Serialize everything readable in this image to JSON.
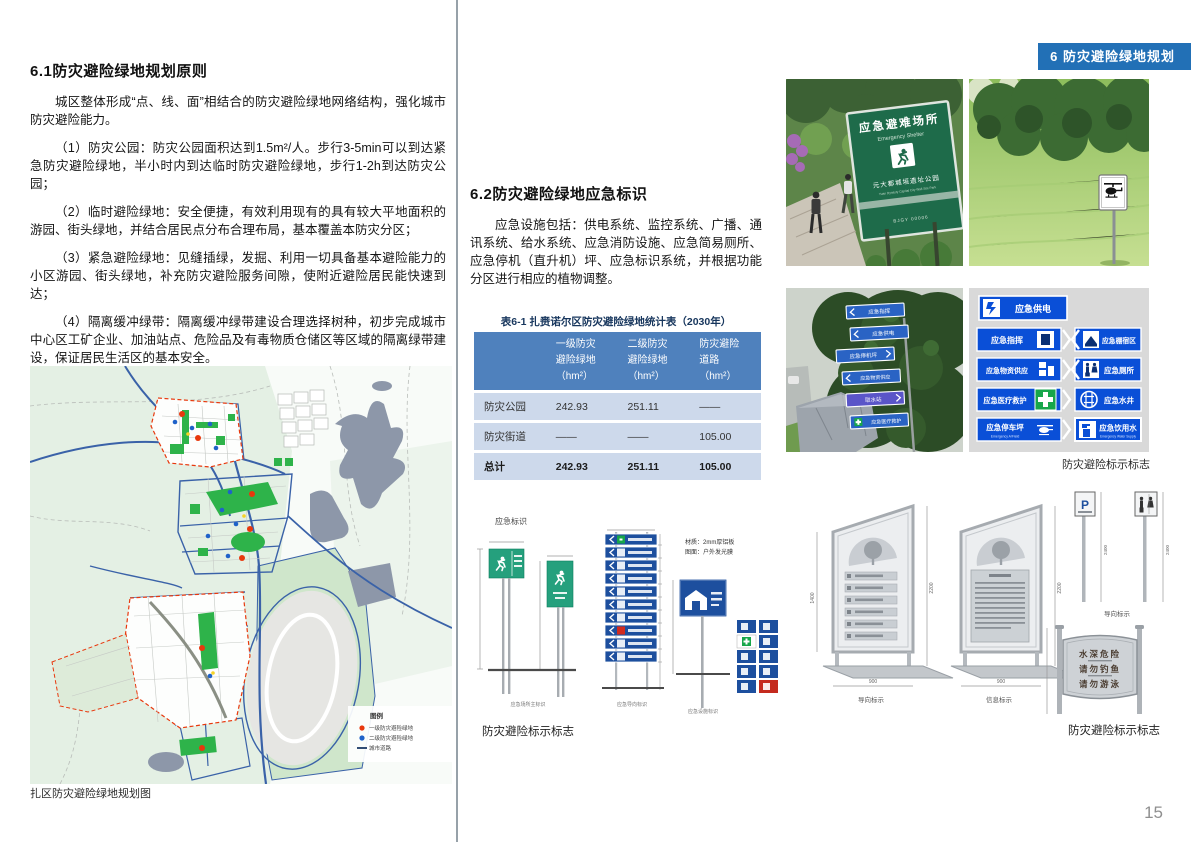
{
  "page": {
    "tab": "6 防灾避险绿地规划",
    "number": "15"
  },
  "left": {
    "heading": "6.1防灾避险绿地规划原则",
    "paragraphs": [
      "城区整体形成“点、线、面”相结合的防灾避险绿地网络结构，强化城市防灾避险能力。",
      "（1）防灾公园：防灾公园面积达到1.5m²/人。步行3-5min可以到达紧急防灾避险绿地，半小时内到达临时防灾避险绿地，步行1-2h到达防灾公园；",
      "（2）临时避险绿地：安全便捷，有效利用现有的具有较大平地面积的游园、街头绿地，并结合居民点分布合理布局，基本覆盖本防灾分区；",
      "（3）紧急避险绿地：见缝插绿，发掘、利用一切具备基本避险能力的小区游园、街头绿地，补充防灾避险服务间隙，使附近避险居民能快速到达；",
      "（4）隔离缓冲绿带：隔离缓冲绿带建设合理选择树种，初步完成城市中心区工矿企业、加油站点、危险品及有毒物质仓储区等区域的隔离绿带建设，保证居民生活区的基本安全。",
      "（5）绿色疏散通道：保障城市对外交通和各主要防灾避险绿地之间交通安全通畅，利用现有城市交通设施，形成系统的、覆盖城区的疏散通道体系。"
    ],
    "map": {
      "legend_title": "图例",
      "legend": [
        {
          "label": "一级防灾避险绿地",
          "color": "#e8380d"
        },
        {
          "label": "二级防灾避险绿地",
          "color": "#1f62c9"
        },
        {
          "label": "城市道路",
          "color": "#1c3a66"
        }
      ],
      "caption": "扎区防灾避险绿地规划图"
    }
  },
  "middle": {
    "heading": "6.2防灾避险绿地应急标识",
    "paragraph": "应急设施包括：供电系统、监控系统、广播、通讯系统、给水系统、应急消防设施、应急简易厕所、应急停机（直升机）坪、应急标识系统，并根据功能分区进行相应的植物调整。",
    "table": {
      "title": "表6-1 扎赉诺尔区防灾避险绿地统计表（2030年）",
      "headers": [
        "",
        "一级防灾\n避险绿地\n（hm²）",
        "二级防灾\n避险绿地\n（hm²）",
        "防灾避险\n道路\n（hm²）"
      ],
      "rows": [
        {
          "label": "防灾公园",
          "c1": "242.93",
          "c2": "251.11",
          "c3": "——"
        },
        {
          "label": "防灾街道",
          "c1": "——",
          "c2": "——",
          "c3": "105.00"
        },
        {
          "label": "总计",
          "c1": "242.93",
          "c2": "251.11",
          "c3": "105.00"
        }
      ]
    },
    "signage": {
      "label": "应急标识",
      "notes": [
        "材质：2mm厚铝板",
        "图面：户外发光膜"
      ],
      "captions": [
        "应急场所主标识",
        "应急导向标识",
        "应急设施标识"
      ],
      "main_caption": "防灾避险标示标志"
    }
  },
  "right": {
    "photo1": {
      "title": "应急避难场所",
      "subtitle": "Emergency Shelter",
      "park": "元大都城垣遗址公园",
      "park_en": "Yuan Dynasty Capital City Wall Site Park",
      "code": "BJGY 00006"
    },
    "photo3_signs": [
      "应急指挥",
      "应急供电",
      "应急停机坪",
      "应急物资供应",
      "取水站",
      "应急医疗救护"
    ],
    "panel": {
      "r1": "应急供电",
      "r2l": "应急指挥",
      "r2r": "应急棚宿区",
      "r3l": "应急物资供应",
      "r3r": "应急厕所",
      "r4l": "应急医疗救护",
      "r4r": "应急水井",
      "r5l": "应急停车坪",
      "r5l_en": "Emergency A/Field",
      "r5r": "应急饮用水",
      "r5r_en": "Emergency Water Supply"
    },
    "caption_top": "防灾避险标示标志",
    "metal": {
      "captions": [
        "导向标示",
        "信息标示",
        "导向标示"
      ],
      "p_label": "P",
      "warning": [
        "水深危险",
        "请勿钓鱼",
        "请勿游泳"
      ],
      "dims": {
        "h1": "1400",
        "h2": "2200",
        "w": "900",
        "p": "2400"
      },
      "caption": "防灾避险标示标志"
    }
  },
  "colors": {
    "accent_blue": "#2270b6",
    "table_header_blue": "#4f81bd",
    "shelter_sign_green": "#1e6b4a",
    "guide_sign_blue": "#0a4fd7"
  }
}
